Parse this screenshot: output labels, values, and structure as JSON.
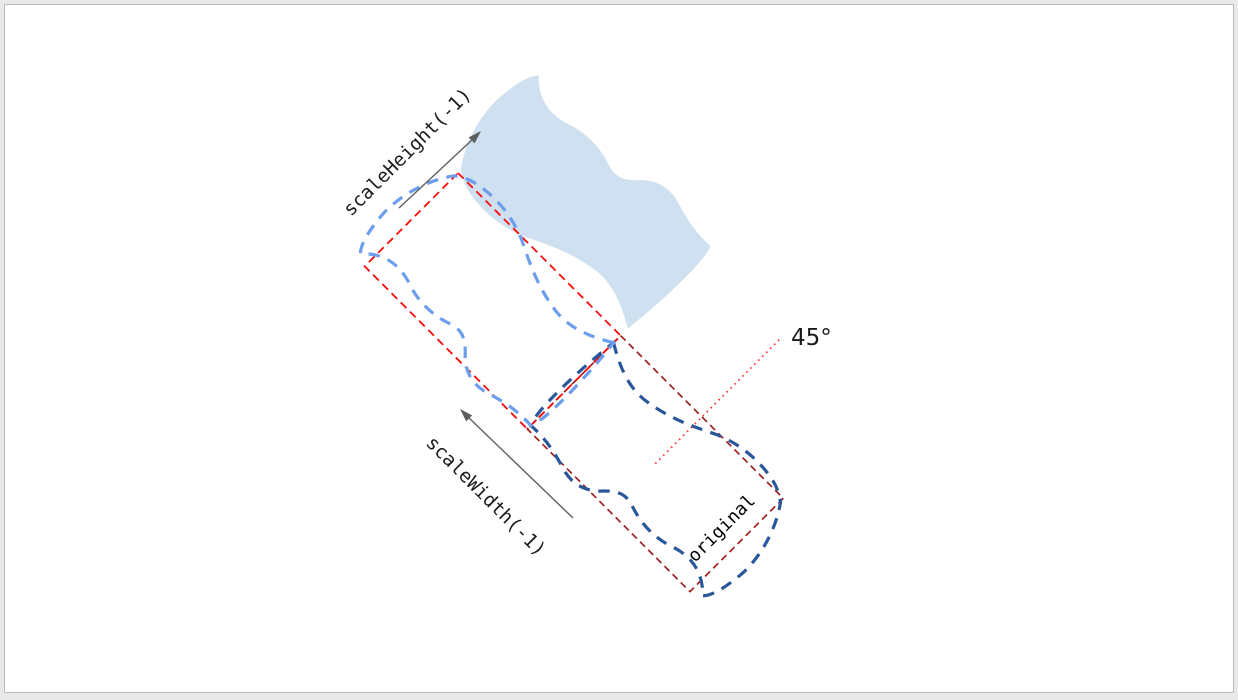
{
  "window": {
    "background": "#e9e9e9",
    "canvas_background": "#ffffff",
    "canvas_border": "#bcbcbc"
  },
  "diagram": {
    "labels": {
      "scale_height": "scaleHeight(-1)",
      "scale_width": "scaleWidth(-1)",
      "original": "original",
      "angle": "45°"
    },
    "colors": {
      "result_fill": "#cfe0f1",
      "flipped_outline": "#6d9eeb",
      "original_outline": "#2a5799",
      "flipped_box": "#fb0a0a",
      "original_box": "#a02020",
      "angle_line": "#ff2a2a",
      "arrow": "#5f5f5f",
      "label_text": "#1c1c1c",
      "original_label_text": "#000000"
    },
    "rotation_deg": 45
  }
}
